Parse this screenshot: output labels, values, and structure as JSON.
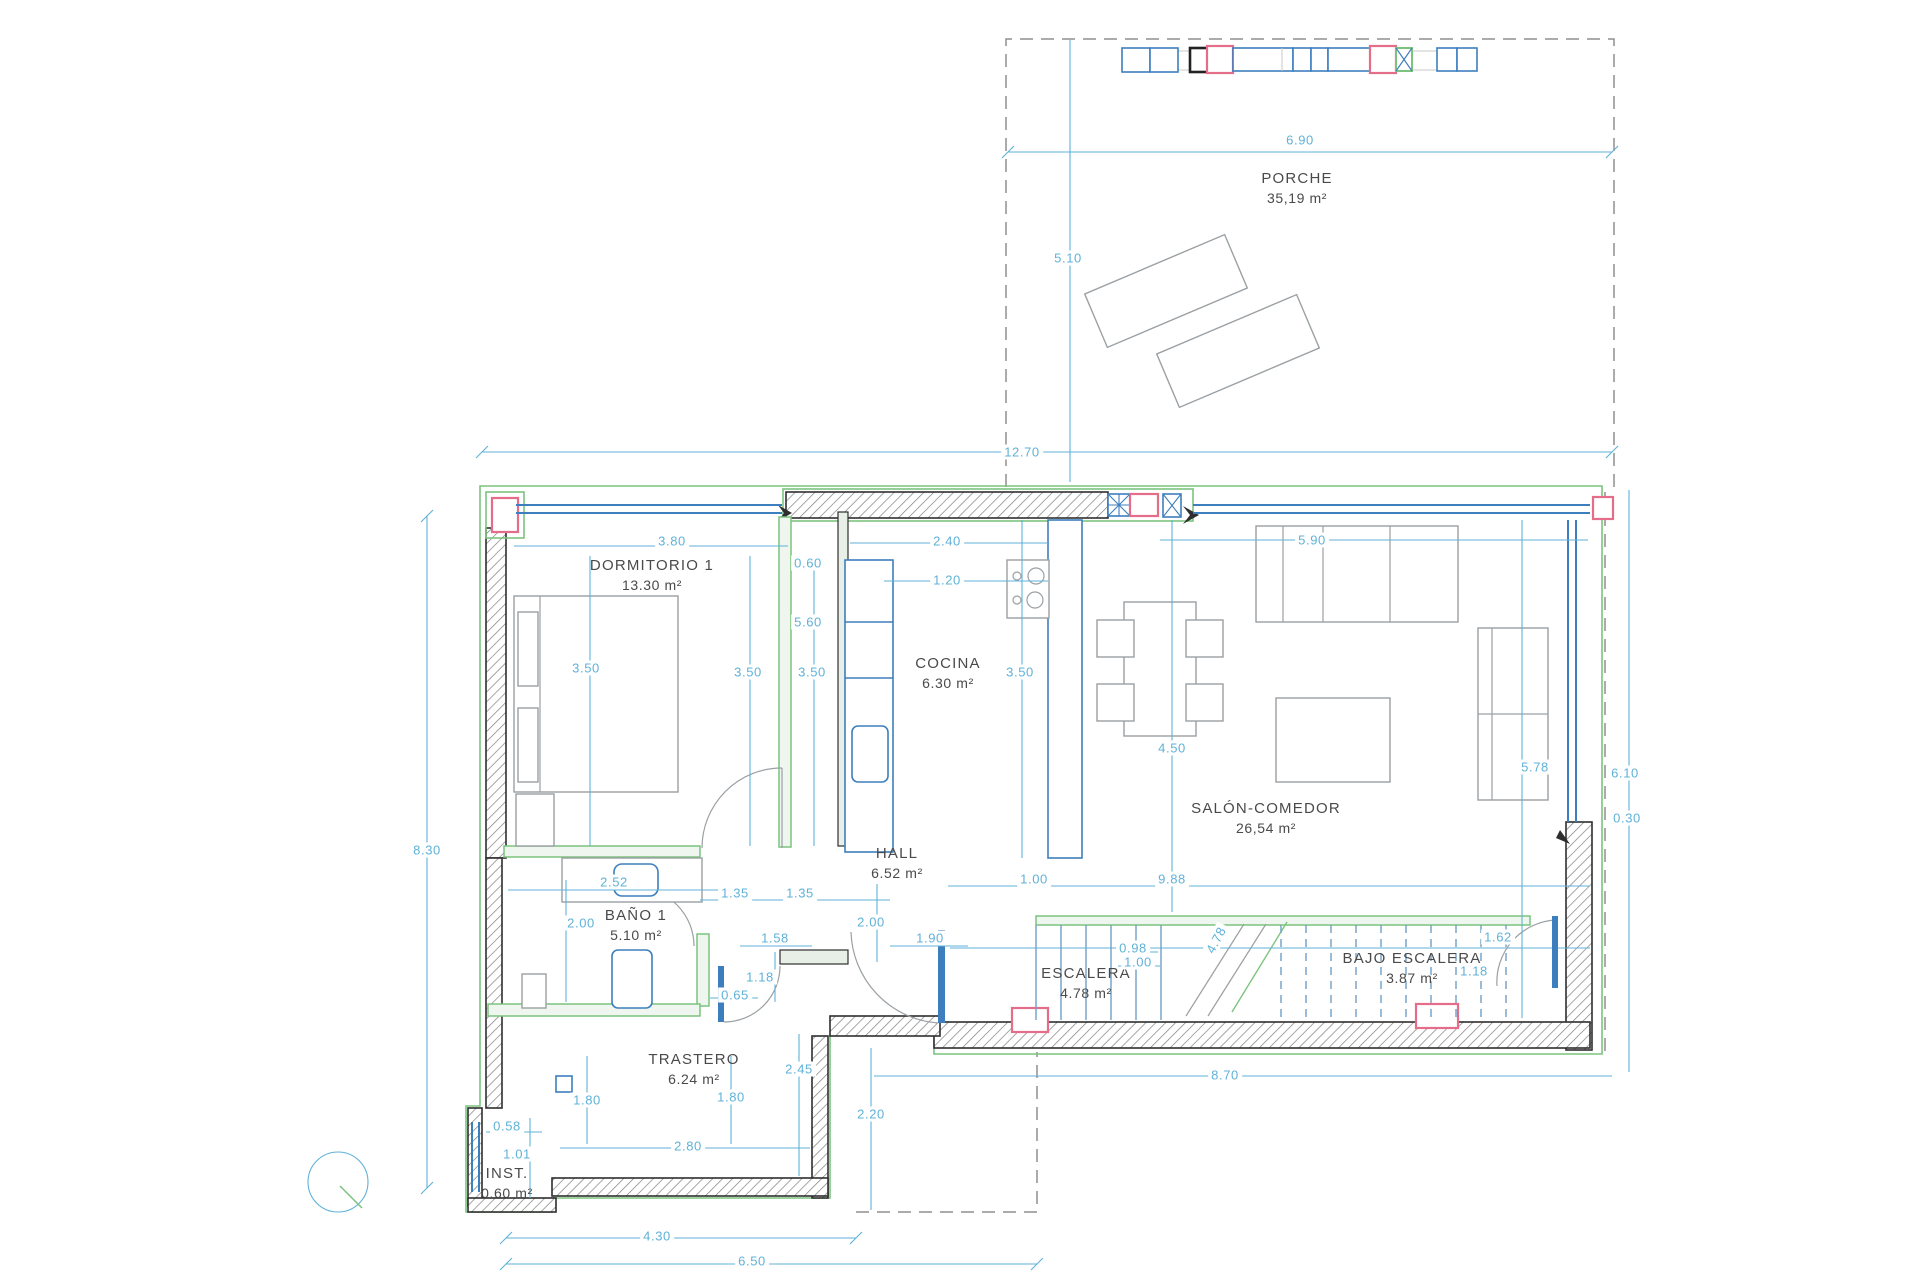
{
  "plan": {
    "type": "floor-plan",
    "colors": {
      "dimension_blue": "#5fb2d8",
      "wall_dark": "#2e2e2e",
      "exterior_green": "#7cc47e",
      "accent_pink": "#e46e8a",
      "window_blue": "#3d7fbe",
      "furniture_gray": "#9aa0a4"
    },
    "rooms": [
      {
        "id": "porche",
        "name": "PORCHE",
        "area": "35,19 m²",
        "x": 1297,
        "y": 188
      },
      {
        "id": "dormitorio-1",
        "name": "DORMITORIO 1",
        "area": "13.30 m²",
        "x": 652,
        "y": 575
      },
      {
        "id": "cocina",
        "name": "COCINA",
        "area": "6.30 m²",
        "x": 948,
        "y": 673
      },
      {
        "id": "salon-comedor",
        "name": "SALÓN-COMEDOR",
        "area": "26,54 m²",
        "x": 1266,
        "y": 818
      },
      {
        "id": "hall",
        "name": "HALL",
        "area": "6.52 m²",
        "x": 897,
        "y": 863
      },
      {
        "id": "bano-1",
        "name": "BAÑO 1",
        "area": "5.10 m²",
        "x": 636,
        "y": 925
      },
      {
        "id": "trastero",
        "name": "TRASTERO",
        "area": "6.24 m²",
        "x": 694,
        "y": 1069
      },
      {
        "id": "escalera",
        "name": "ESCALERA",
        "area": "4.78 m²",
        "x": 1086,
        "y": 983
      },
      {
        "id": "bajo-escalera",
        "name": "BAJO ESCALERA",
        "area": "3.87 m²",
        "x": 1412,
        "y": 968
      },
      {
        "id": "inst",
        "name": "INST.",
        "area": "0.60 m²",
        "x": 507,
        "y": 1183
      }
    ],
    "dimensions": [
      {
        "t": "6.90",
        "x": 1300,
        "y": 140
      },
      {
        "t": "5.10",
        "x": 1068,
        "y": 258
      },
      {
        "t": "12.70",
        "x": 1022,
        "y": 452
      },
      {
        "t": "8.30",
        "x": 427,
        "y": 850
      },
      {
        "t": "3.80",
        "x": 672,
        "y": 541
      },
      {
        "t": "0.60",
        "x": 808,
        "y": 563
      },
      {
        "t": "2.40",
        "x": 947,
        "y": 541
      },
      {
        "t": "1.20",
        "x": 947,
        "y": 580
      },
      {
        "t": "5.90",
        "x": 1312,
        "y": 540
      },
      {
        "t": "3.50",
        "x": 586,
        "y": 668
      },
      {
        "t": "5.60",
        "x": 808,
        "y": 622
      },
      {
        "t": "3.50",
        "x": 748,
        "y": 672
      },
      {
        "t": "3.50",
        "x": 812,
        "y": 672
      },
      {
        "t": "3.50",
        "x": 1020,
        "y": 672
      },
      {
        "t": "4.50",
        "x": 1172,
        "y": 748
      },
      {
        "t": "5.78",
        "x": 1535,
        "y": 767
      },
      {
        "t": "6.10",
        "x": 1625,
        "y": 773
      },
      {
        "t": "0.30",
        "x": 1627,
        "y": 818
      },
      {
        "t": "2.52",
        "x": 614,
        "y": 882
      },
      {
        "t": "2.00",
        "x": 581,
        "y": 923
      },
      {
        "t": "1.35",
        "x": 735,
        "y": 893
      },
      {
        "t": "1.35",
        "x": 800,
        "y": 893
      },
      {
        "t": "1.00",
        "x": 1034,
        "y": 879
      },
      {
        "t": "9.88",
        "x": 1172,
        "y": 879
      },
      {
        "t": "1.58",
        "x": 775,
        "y": 938
      },
      {
        "t": "2.00",
        "x": 871,
        "y": 922
      },
      {
        "t": "1.90",
        "x": 930,
        "y": 938
      },
      {
        "t": "1.18",
        "x": 760,
        "y": 977
      },
      {
        "t": "0.65",
        "x": 735,
        "y": 995
      },
      {
        "t": "0.98",
        "x": 1133,
        "y": 948
      },
      {
        "t": "1.00",
        "x": 1138,
        "y": 962
      },
      {
        "t": "4.78",
        "x": 1216,
        "y": 940,
        "rot": -62
      },
      {
        "t": "1.62",
        "x": 1498,
        "y": 937
      },
      {
        "t": "1.18",
        "x": 1474,
        "y": 971
      },
      {
        "t": "2.45",
        "x": 799,
        "y": 1069
      },
      {
        "t": "1.80",
        "x": 587,
        "y": 1100
      },
      {
        "t": "1.80",
        "x": 731,
        "y": 1097
      },
      {
        "t": "2.80",
        "x": 688,
        "y": 1146
      },
      {
        "t": "2.20",
        "x": 871,
        "y": 1114
      },
      {
        "t": "8.70",
        "x": 1225,
        "y": 1075
      },
      {
        "t": "0.58",
        "x": 507,
        "y": 1126
      },
      {
        "t": "1.01",
        "x": 517,
        "y": 1154
      },
      {
        "t": "4.30",
        "x": 657,
        "y": 1236
      },
      {
        "t": "6.50",
        "x": 752,
        "y": 1261
      }
    ]
  }
}
